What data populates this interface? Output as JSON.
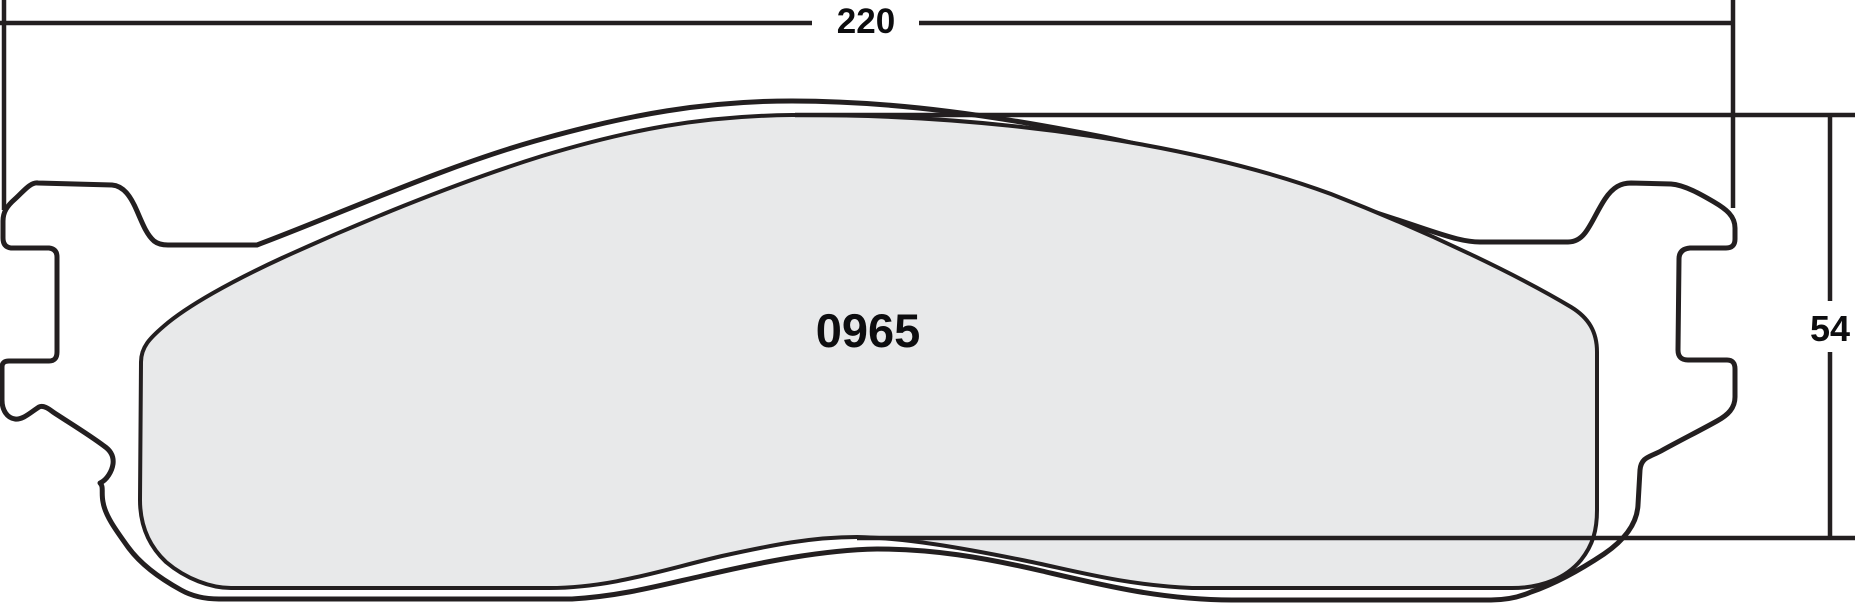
{
  "drawing": {
    "title": "brake pad outline drawing",
    "part_number": "0965",
    "dimensions": {
      "width_label": "220",
      "height_label": "54"
    },
    "colors": {
      "line": "#231f20",
      "pad_fill": "#e8e9ea",
      "plate_fill": "#ffffff",
      "background": "#ffffff",
      "text": "#0d0d0f"
    }
  }
}
